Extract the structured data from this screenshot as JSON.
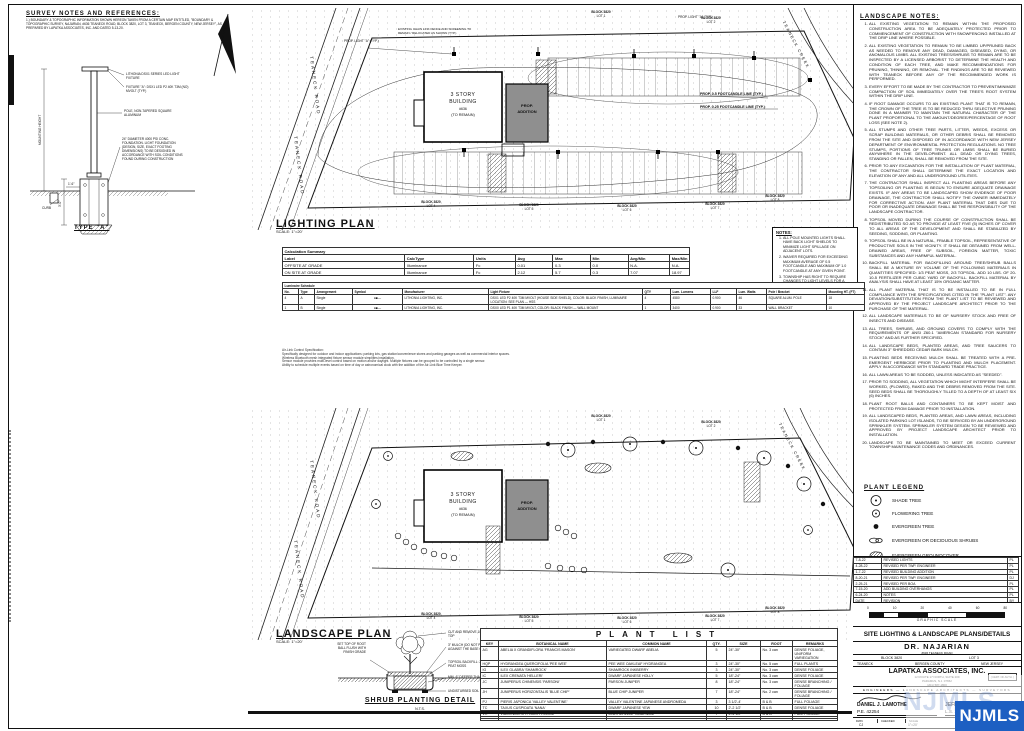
{
  "survey": {
    "title": "SURVEY NOTES AND REFERENCES:",
    "note": "1.) BOUNDARY & TOPOGRAPHIC INFORMATION SHOWN HEREON TAKEN FROM A CERTAIN MAP ENTITLED, \"BOUNDARY & TOPOGRAPHIC SURVEY, NAJARIAN, #636 TEANECK ROAD, BLOCK 3820, LOT 3, TEANECK, BERGEN COUNTY, NEW JERSEY\", AS PREPARED BY LAPATKA ASSOCIATES, INC. AND DATED 5-13-20."
  },
  "pole_detail": {
    "title": "TYPE \"A\"",
    "callout_fixture": "LITHONIA DSX1 SERIES LED LIGHT FIXTURE",
    "callout_fixture2": "FIXTURE \"A\": DSX1 LED P2 40K T3M (NO) MVOLT (TYP.)",
    "callout_pole": "POLE, NON-TAPERED SQUARE ALUMINUM",
    "callout_foundation": "24\" DIAMETER 4000 PSI CONC. FOUNDATION. LIGHT FOUNDATION (DESIGN, SIZE, EXACT FOOTING DIMENSIONS) TO BE DESIGNED IN ACCORDANCE WITH SOIL CONDITIONS FOUND DURING CONSTRUCTION",
    "callout_curb": "CURB",
    "dim_height": "MOUNTING HEIGHT",
    "dim_depth": "3'-0\"",
    "dim_width": "1'-6\""
  },
  "lighting_plan": {
    "title": "LIGHTING PLAN",
    "scale": "SCALE: 1\"=20'",
    "road": "TEANECK ROAD",
    "creek": "TEANECK CREEK",
    "building": {
      "l1": "3 STORY",
      "l2": "BUILDING",
      "l3": "#636",
      "l4": "(TO REMAIN)"
    },
    "addition1": "PROP.",
    "addition2": "ADDITION",
    "fence_note": "EXISTING CHAIN LINK FENCE AND SCREENING TO REMAIN / RELOCATED AS SHOWN (TYP.)",
    "fc05": "PROP. 0.5 FOOTCANDLE LINE (TYP.)",
    "fc025": "PROP. 0.25 FOOTCANDLE LINE (TYP.)",
    "prop_light": "PROP. LIGHT \"A\" (TYP.)",
    "lots": [
      {
        "b": "BLOCK 3820",
        "l": "LOT 1"
      },
      {
        "b": "BLOCK 3820",
        "l": "LOT 2"
      },
      {
        "b": "BLOCK 3820",
        "l": "LOT 4"
      },
      {
        "b": "BLOCK 3820",
        "l": "LOT 5"
      },
      {
        "b": "BLOCK 3820",
        "l": "LOT 6"
      },
      {
        "b": "BLOCK 3820",
        "l": "LOT 7"
      },
      {
        "b": "BLOCK 3820",
        "l": "LOT 8"
      }
    ]
  },
  "notes_box": {
    "title": "NOTES:",
    "items": [
      "ALL POLE MOUNTED LIGHTS SHALL HAVE BACK LIGHT SHIELDS TO MINIMIZE LIGHT SPILLAGE ON ADJACENT LOTS.",
      "WAIVER REQUIRED FOR EXCEEDING MAXIMUM AVERAGE OF 0.5 FOOTCANDLE AND MAXIMUM OF 1.0 FOOTCANDLE AT ANY GIVEN POINT.",
      "TOWNSHIP HAS RIGHT TO REQUIRE CHANGES TO LIGHT LEVELS FOR A PERIOD OF 1 YEAR FOLLOWING ISSUANCE OF CERTIFICATE OF OCCUPANCY."
    ]
  },
  "calc_summary": {
    "title": "Calculation Summary",
    "headers": [
      "Label",
      "CalcType",
      "Units",
      "Avg",
      "Max",
      "Min",
      "Avg/Min",
      "Max/Min"
    ],
    "rows": [
      {
        "label": "OFFSITE AT GRADE",
        "calctype": "Illuminance",
        "units": "Fc",
        "avg": "0.01",
        "max": "0.3",
        "min": "0.0",
        "avgmin": "N.A.",
        "maxmin": "N.A."
      },
      {
        "label": "ON SITE AT GRADE",
        "calctype": "Illuminance",
        "units": "Fc",
        "avg": "2.12",
        "max": "5.7",
        "min": "0.3",
        "avgmin": "7.07",
        "maxmin": "18.97"
      }
    ]
  },
  "luminaire_schedule": {
    "title": "Luminaire Schedule",
    "headers": [
      "No.",
      "Type",
      "Arrangement",
      "Symbol",
      "Manufacturer",
      "Light Fixture",
      "QTY",
      "Lum. Lumens",
      "LLF",
      "Lum. Watts",
      "Pole / Bracket",
      "Mounting HT. (FT)"
    ],
    "rows": [
      {
        "no": "4",
        "type": "A",
        "arr": "Single",
        "sym": "●■—",
        "mfr": "LITHONIA LIGHTING, INC.",
        "fix": "DSX1 LED P2 40K T3M MVOLT (HOUSE SIDE SHIELD), COLOR: BLACK FINISH, LUMINAIRE LOCATION: SEE PLAN — HSS",
        "qty": "4",
        "lum": "4580",
        "llf": "0.900",
        "watts": "46",
        "pole": "SQUARE ALUM. POLE",
        "mt": "18"
      },
      {
        "no": "1",
        "type": "B",
        "arr": "Single",
        "sym": "●■—",
        "mfr": "LITHONIA LIGHTING, INC.",
        "fix": "DSX0 LED P1 40K T3M MVOLT, COLOR: BLACK FINISH — WALL MOUNT",
        "qty": "1",
        "lum": "3400",
        "llf": "0.900",
        "watts": "33",
        "pole": "WALL BRACKET",
        "mt": "10"
      }
    ]
  },
  "control_spec": {
    "lines": [
      "Air-Link Control Specification:",
      "Specifically designed for outdoor and indoor applications: parking lots, gas station/convenience stores and parking garages as well as commercial interior spaces.",
      "Wireless Bluetooth mesh integrated fixture sensor module simplifies installation.",
      "Sensor module provides multi-level control based on motion and/or daylight. Multiple fixtures can be grouped to be controlled by a single sensor.",
      "Ability to schedule multiple events based on time of day or astronomical clock with the addition of the Air-Link Blue Time Keeper."
    ]
  },
  "landscape_notes": {
    "title": "LANDSCAPE NOTES:",
    "items": [
      "ALL EXISTING VEGETATION TO REMAIN WITHIN THE PROPOSED CONSTRUCTION AREA TO BE ADEQUATELY PROTECTED PRIOR TO COMMENCEMENT OF CONSTRUCTION WITH SNOWFENCING INSTALLED AT THE DRIP LINE WHERE POSSIBLE.",
      "ALL EXISTING VEGETATION TO REMAIN TO BE LIMBED UP/PRUNED BACK AS NEEDED TO REMOVE ANY DEAD, DAMAGED, DISEASED, DYING, OR ANOMALOUS LIMBS. ALL EXISTING TREES/SHRUBS TO REMAIN ARE TO BE INSPECTED BY A LICENSED ARBORIST TO DETERMINE THE HEALTH AND CONDITION OF EACH TREE, AND MAKE RECOMMENDATIONS FOR PRUNING, THINNING, OR REMOVAL. THE FINDINGS ARE TO BE REVIEWED WITH TEANECK BEFORE ANY OF THE RECOMMENDED WORK IS PERFORMED.",
      "EVERY EFFORT TO BE MADE BY THE CONTRACTOR TO PREVENT/MINIMIZE COMPACTION OF SOIL IMMEDIATELY OVER THE TREE'S ROOT SYSTEM WITHIN THE DRIP LINE.",
      "IF ROOT DAMAGE OCCURS TO AN EXISTING PLANT THAT IS TO REMAIN, THE CROWN OF THE TREE IS TO BE REDUCED THRU SELECTIVE PRUNING DONE IN A MANNER TO MAINTAIN THE NATURAL CHARACTER OF THE PLANT PROPORTIONAL TO THE AMOUNT/DEGREE/PERCENTAGE OF ROOT LOSS (SEE NOTE 2).",
      "ALL STUMPS AND OTHER TREE PARTS, LITTER, WEEDS, EXCESS OR SCRAP BUILDING MATERIALS, OR OTHER DEBRIS SHALL BE REMOVED FROM THE SITE AND DISPOSED OF IN ACCORDANCE WITH NEW JERSEY DEPARTMENT OF ENVIRONMENTAL PROTECTION REGULATIONS. NO TREE STUMPS, PORTIONS OF TREE TRUNKS OR LIMBS SHALL BE BURIED ANYWHERE IN THE DEVELOPMENT. ALL DEAD OR DYING TREES, STANDING OR FALLEN, SHALL BE REMOVED FROM THE SITE.",
      "PRIOR TO ANY EXCAVATION FOR THE INSTALLATION OF PLANT MATERIAL, THE CONTRACTOR SHALL DETERMINE THE EXACT LOCATION AND ELEVATION OF ANY AND ALL UNDERGROUND UTILITIES.",
      "THE CONTRACTOR SHALL INSPECT ALL PLANTING AREAS BEFORE ANY TOPSOILING OR PLANTING IS BEGUN TO ENSURE ADEQUATE DRAINAGE EXISTS. IF ANY AREAS TO BE LANDSCAPED SHOW EVIDENCE OF POOR DRAINAGE, THE CONTRACTOR SHALL NOTIFY THE OWNER IMMEDIATELY FOR CORRECTIVE ACTION. ANY PLANT MATERIAL THAT DIES DUE TO POOR OR INADEQUATE DRAINAGE SHALL BE THE RESPONSIBILITY OF THE LANDSCAPE CONTRACTOR.",
      "TOPSOIL MOVED DURING THE COURSE OF CONSTRUCTION SHALL BE REDISTRIBUTED SO AS TO PROVIDE AT LEAST FIVE (5) INCHES OF COVER TO ALL AREAS OF THE DEVELOPMENT AND SHALL BE STABILIZED BY SEEDING, SODDING, OR PLANTING.",
      "TOPSOIL SHALL BE IN A NATURAL, FRIABLE TOPSOIL, REPRESENTATIVE OF PRODUCTIVE SOILS IN THE VICINITY. IT SHALL BE OBTAINED FROM WELL-DRAINED AREAS, FREE OF SUBSOIL, FOREIGN MATTER, TOXIC SUBSTANCES AND ANY HARMFUL MATERIAL.",
      "BACKFILL MATERIAL FOR BACKFILLING AROUND TREE/SHRUB BALLS SHALL BE A MIXTURE BY VOLUME OF THE FOLLOWING MATERIALS IN QUANTITIES SPECIFIED: 1/3 PEAT MOSS, 2/3 TOPSOIL. ADD 10 LBS. OF 20-10-5 FERTILIZER PER CUBIC YARD OF BACKFILL. BACKFILL MATERIAL BY ANALYSIS SHALL HAVE AT LEAST 15% ORGANIC MATTER.",
      "ALL PLANT MATERIAL THAT IS TO BE INSTALLED TO BE IN FULL COMPLIANCE WITH THE SPECIFICATIONS CITED IN THE \"PLANT LIST\". ANY DEVIATION/SUBSTITUTION FROM THE PLANT LIST TO BE REVIEWED AND APPROVED BY THE PROJECT LANDSCAPE ARCHITECT PRIOR TO THE PURCHASE OF THE MATERIAL.",
      "ALL LANDSCAPE MATERIALS TO BE OF NURSERY STOCK AND FREE OF INSECTS AND DISEASE.",
      "ALL TREES, SHRUBS, AND GROUND COVERS TO COMPLY WITH THE REQUIREMENTS OF ANSI Z60.1 \"AMERICAN STANDARD FOR NURSERY STOCK\" AND AS FURTHER SPECIFIED.",
      "ALL LANDSCAPE BEDS, PLANTED AREAS, AND TREE SAUCERS TO CONTAIN 3\" SHREDDED CEDAR BARK MULCH.",
      "PLANTING BEDS RECEIVING MULCH SHALL BE TREATED WITH A PRE-EMERGENT HERBICIDE PRIOR TO PLANTING AND MULCH PLACEMENT. APPLY IN ACCORDANCE WITH STANDARD TRADE PRACTICE.",
      "ALL LAWN AREAS TO BE SODDED, UNLESS INDICATED AS \"SEEDED\".",
      "PRIOR TO SODDING, ALL VEGETATION WHICH MIGHT INTERFERE SHALL BE WORKED, (PLOWED), RAKED AND THE DEBRIS REMOVED FROM THE SITE. SEED BEDS SHALL BE THOROUGHLY TILLED TO A DEPTH OF AT LEAST SIX (6) INCHES.",
      "PLANT ROOT BALLS AND CONTAINERS TO BE KEPT MOIST AND PROTECTED FROM DAMAGE PRIOR TO INSTALLATION.",
      "ALL LANDSCAPED BEDS, PLANTED AREAS, AND LAWN AREAS, INCLUDING ISOLATED PARKING LOT ISLANDS, TO BE SERVICED BY AN UNDERGROUND SPRINKLER SYSTEM. SPRINKLER SYSTEM DESIGN TO BE REVIEWED AND APPROVED BY PROJECT LANDSCAPE ARCHITECT PRIOR TO INSTALLATION.",
      "LANDSCAPE TO BE MAINTAINED TO MEET OR EXCEED CURRENT TOWNSHIP MAINTENANCE CODES AND ORDINANCES."
    ]
  },
  "plant_legend": {
    "title": "PLANT LEGEND",
    "items": [
      {
        "label": "SHADE TREE"
      },
      {
        "label": "FLOWERING TREE"
      },
      {
        "label": "EVERGREEN TREE"
      },
      {
        "label": "EVERGREEN OR DECIDUOUS SHRUBS"
      },
      {
        "label": "EVERGREEN GROUNDCOVER"
      }
    ]
  },
  "landscape_plan": {
    "title": "LANDSCAPE PLAN",
    "scale": "SCALE: 1\"=20'",
    "road": "TEANECK ROAD",
    "creek": "TEANECK CREEK",
    "building": {
      "l1": "3 STORY",
      "l2": "BUILDING",
      "l3": "#636",
      "l4": "(TO REMAIN)"
    },
    "addition1": "PROP.",
    "addition2": "ADDITION",
    "lots": [
      {
        "b": "BLOCK 3820",
        "l": "LOT 1"
      },
      {
        "b": "BLOCK 3820",
        "l": "LOT 2"
      },
      {
        "b": "BLOCK 3820",
        "l": "LOT 4"
      },
      {
        "b": "BLOCK 3820",
        "l": "LOT 5"
      },
      {
        "b": "BLOCK 3820",
        "l": "LOT 6"
      },
      {
        "b": "BLOCK 3820",
        "l": "LOT 7"
      },
      {
        "b": "BLOCK 3820",
        "l": "LOT 8"
      }
    ]
  },
  "shrub_detail": {
    "title": "SHRUB PLANTING DETAIL",
    "nts": "N.T.S.",
    "c_left": "SET TOP OF ROOT BALL FLUSH WITH FINISH GRADE",
    "c1": "CUT AND REMOVE 1/3 OF BURLAP AT TOP",
    "c2": "3\" MULCH (DO NOT PUT MULCH AGAINST THE BASE OF THE PLANT)",
    "c3": "TOPSOIL BACKFILL: 2/3 TOPSOIL, 1/3 PEAT MOSS",
    "c4": "MIN. 6\" DEEPER THAN ROOT BALL",
    "c5": "UNDISTURBED SOIL"
  },
  "plant_list": {
    "title": "PLANT LIST",
    "headers": [
      "KEY",
      "BOTANICAL NAME",
      "COMMON NAME",
      "QTY.",
      "SIZE",
      "ROOT",
      "REMARKS"
    ],
    "rows": [
      {
        "key": "AG",
        "bot": "ABELIA X GRANDIFLORA 'FRANCIS MASON'",
        "com": "VARIEGATED DWARF ABELIA",
        "qty": "5",
        "size": "24\"-30\"",
        "root": "No. 3 can",
        "rem": "DENSE FOLIAGE, UNIFORM VARIEGATION"
      },
      {
        "key": "HQP",
        "bot": "HYDRANGEA QUERCIFOLIA 'PEE WEE'",
        "com": "PEE WEE OAKLEAF HYDRANGEA",
        "qty": "3",
        "size": "24\"-30\"",
        "root": "No. 5 can",
        "rem": "FULL PLANTS"
      },
      {
        "key": "IG",
        "bot": "ILEX GLABRA 'SHAMROCK'",
        "com": "SHAMROCK INKBERRY",
        "qty": "3",
        "size": "24\"-30\"",
        "root": "No. 3 can",
        "rem": "DENSE FOLIAGE"
      },
      {
        "key": "IC",
        "bot": "ILEX CRENATA 'HELLERI'",
        "com": "DWARF JAPANESE HOLLY",
        "qty": "5",
        "size": "18\"-24\"",
        "root": "No. 3 can",
        "rem": "DENSE FOLIAGE"
      },
      {
        "key": "JC",
        "bot": "JUNIPERUS CHINENSIS 'PARSONI'",
        "com": "PARSON JUNIPER",
        "qty": "8",
        "size": "18\"-24\"",
        "root": "No. 3 can",
        "rem": "DENSE BRANCHING / FOLIAGE"
      },
      {
        "key": "JH",
        "bot": "JUNIPERUS HORIZONTALIS 'BLUE CHIP'",
        "com": "BLUE CHIP JUNIPER",
        "qty": "7",
        "size": "18\"-24\"",
        "root": "No. 2 can",
        "rem": "DENSE BRANCHING / FOLIAGE"
      },
      {
        "key": "PJ",
        "bot": "PIERIS JAPONICA 'VALLEY VALENTINE'",
        "com": "VALLEY VALENTINE JAPANESE ANDROMEDA",
        "qty": "3",
        "size": "3 1/2'-4'",
        "root": "B & B",
        "rem": "FULL FOLIAGE"
      },
      {
        "key": "TC",
        "bot": "TAXUS CUSPIDATA 'NANA'",
        "com": "DWARF JAPANESE YEW",
        "qty": "10",
        "size": "2'-2 1/2'",
        "root": "B & B",
        "rem": "DENSE FOLIAGE"
      },
      {
        "key": "VR",
        "bot": "VIBURNUM RHYTIDOPHYLLUM",
        "com": "LEATHERLEAF VIBURNUM",
        "qty": "7",
        "size": "4'-4 1/2'",
        "root": "B & B",
        "rem": "FULL FOLIAGE"
      },
      {
        "key": "",
        "bot": "",
        "com": "",
        "qty": "",
        "size": "",
        "root": "",
        "rem": ""
      },
      {
        "key": "",
        "bot": "",
        "com": "",
        "qty": "",
        "size": "",
        "root": "",
        "rem": ""
      }
    ]
  },
  "title_block": {
    "revisions": [
      {
        "d": "7-8-22",
        "r": "REVISED LIGHTS",
        "b": "PL"
      },
      {
        "d": "4-28-22",
        "r": "REVISED PER TWP. ENGINEER",
        "b": "PL"
      },
      {
        "d": "1-7-22",
        "r": "REVISED BUILDING ADDITION",
        "b": "PL"
      },
      {
        "d": "8-20-21",
        "r": "REVISED PER TWP. ENGINEER",
        "b": "DJ"
      },
      {
        "d": "2-25-21",
        "r": "REVISED PER BOA",
        "b": "PL"
      },
      {
        "d": "7-15-20",
        "r": "ADD BUILDING OVERHANGS",
        "b": "PL"
      },
      {
        "d": "6-24-20",
        "r": "NOTES",
        "b": "PL"
      },
      {
        "d": "DATE",
        "r": "REVISION",
        "b": "BY"
      }
    ],
    "scale_ticks": [
      "0",
      "10",
      "20",
      "40",
      "60",
      "80"
    ],
    "scale_label": "GRAPHIC SCALE",
    "sheet_title": "SITE LIGHTING & LANDSCAPE PLANS/DETAILS",
    "project": "DR. NAJARIAN",
    "project_addr": "#636 TEANECK ROAD",
    "block": "BLOCK 3820",
    "lot": "LOT 3",
    "town": "TEANECK",
    "county": "BERGEN COUNTY",
    "state": "NEW JERSEY",
    "firm": "LAPATKA ASSOCIATES, INC.",
    "firm_addr1": "12 ROUTE 17 NORTH, SUITE 209",
    "firm_addr2": "PARAMUS, N.J. 07652",
    "firm_phone": "(201) 587-1800",
    "cert": "( CERT. OF AUTH. )",
    "tagline": "ENGINEERS — LANDSCAPE ARCHITECTS — SURVEYORS",
    "eng1_name": "DANIEL J. LAMOTHE",
    "eng1_lic": "P.E. 42254",
    "eng1_role": "PROFESSIONAL ENGINEER",
    "eng2_name": "JEFFREY H. KLEINE",
    "eng2_lic": "L.S. 35848",
    "eng2_role": "PROFESSIONAL LAND SURVEYOR",
    "dwn_label": "DWN",
    "dwn_val": "CJ",
    "checked_label": "CHECKED",
    "scale_cell_label": "SCALE",
    "scale_cell_val": "1\"=20'",
    "watermark": "NJMLS"
  }
}
